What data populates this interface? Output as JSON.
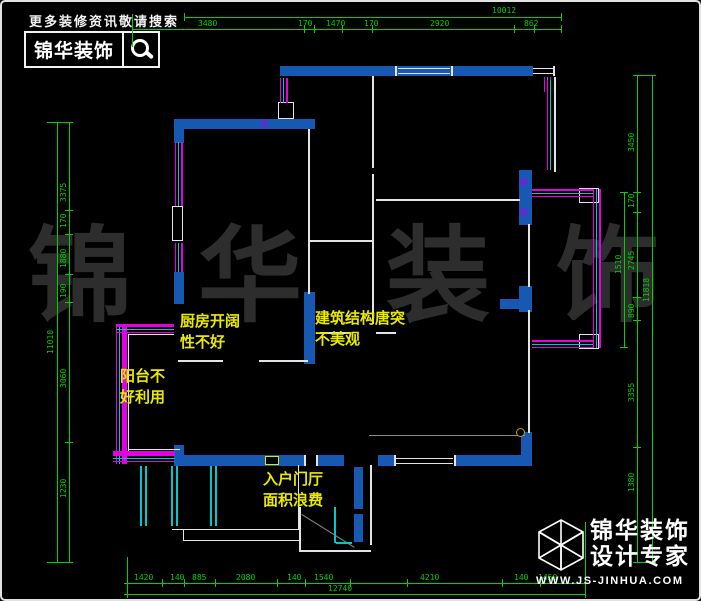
{
  "header": {
    "tagline": "更多装修资讯敬请搜索",
    "brand": "锦华装饰",
    "icon": "magnifier-icon"
  },
  "footer": {
    "brand": "锦华装饰",
    "subtitle": "设计专家",
    "website": "WWW.JS-JINHUA.COM",
    "icon": "cube-logo-icon"
  },
  "watermark": {
    "chars": [
      {
        "t": "锦",
        "x": 26
      },
      {
        "t": "华",
        "x": 196
      },
      {
        "t": "装",
        "x": 384
      },
      {
        "t": "饰",
        "x": 554
      }
    ]
  },
  "colors": {
    "wall": "#1658b2",
    "line": "#e4e4e4",
    "green": "#00d200",
    "magenta": "#e400e4",
    "cyan": "#00c8c8",
    "yellow": "#e3e300",
    "violet": "#5a2fd0",
    "gray": "#8a8a8a",
    "amber": "#cf9a00"
  },
  "plan": {
    "notes": [
      {
        "t": "厨房开阔\n性不好",
        "x": 178,
        "y": 309
      },
      {
        "t": "建筑结构唐突\n不美观",
        "x": 313,
        "y": 306
      },
      {
        "t": "阳台不\n好利用",
        "x": 118,
        "y": 364
      },
      {
        "t": "入户门厅\n面积浪费",
        "x": 261,
        "y": 467
      }
    ],
    "dim_labels": [
      {
        "t": "10012",
        "x": 490,
        "y": 5
      },
      {
        "t": "3480",
        "x": 196,
        "y": 18
      },
      {
        "t": "170",
        "x": 296,
        "y": 18
      },
      {
        "t": "1470",
        "x": 324,
        "y": 18
      },
      {
        "t": "170",
        "x": 362,
        "y": 18
      },
      {
        "t": "2920",
        "x": 428,
        "y": 18
      },
      {
        "t": "862",
        "x": 522,
        "y": 18
      },
      {
        "t": "1420",
        "x": 132,
        "y": 572
      },
      {
        "t": "140",
        "x": 168,
        "y": 572
      },
      {
        "t": "885",
        "x": 190,
        "y": 572
      },
      {
        "t": "2080",
        "x": 234,
        "y": 572
      },
      {
        "t": "140",
        "x": 285,
        "y": 572
      },
      {
        "t": "1540",
        "x": 312,
        "y": 572
      },
      {
        "t": "4210",
        "x": 418,
        "y": 572
      },
      {
        "t": "140",
        "x": 512,
        "y": 572
      },
      {
        "t": "1450",
        "x": 536,
        "y": 572
      },
      {
        "t": "12740",
        "x": 326,
        "y": 583
      },
      {
        "t": "3375",
        "x": 58,
        "y": 200,
        "rot": 1
      },
      {
        "t": "170",
        "x": 58,
        "y": 226,
        "rot": 1
      },
      {
        "t": "1880",
        "x": 58,
        "y": 266,
        "rot": 1
      },
      {
        "t": "190",
        "x": 58,
        "y": 296,
        "rot": 1
      },
      {
        "t": "3060",
        "x": 58,
        "y": 386,
        "rot": 1
      },
      {
        "t": "1230",
        "x": 58,
        "y": 496,
        "rot": 1
      },
      {
        "t": "11010",
        "x": 45,
        "y": 352,
        "rot": 1
      },
      {
        "t": "3450",
        "x": 626,
        "y": 150,
        "rot": 1
      },
      {
        "t": "170",
        "x": 626,
        "y": 206,
        "rot": 1
      },
      {
        "t": "2745",
        "x": 626,
        "y": 268,
        "rot": 1
      },
      {
        "t": "890",
        "x": 626,
        "y": 316,
        "rot": 1
      },
      {
        "t": "3355",
        "x": 626,
        "y": 400,
        "rot": 1
      },
      {
        "t": "1380",
        "x": 626,
        "y": 490,
        "rot": 1
      },
      {
        "t": "11818",
        "x": 641,
        "y": 300,
        "rot": 1
      },
      {
        "t": "1510",
        "x": 613,
        "y": 272,
        "rot": 1
      }
    ],
    "ticks": [
      {
        "y": 11,
        "xs": [
          182,
          559
        ]
      },
      {
        "y": 23,
        "xs": [
          130,
          302,
          312,
          340,
          370,
          512,
          532,
          559
        ]
      },
      {
        "y": 577,
        "xs": [
          125,
          160,
          182,
          213,
          275,
          303,
          348,
          405,
          500,
          538,
          583
        ]
      },
      {
        "y": 588,
        "xs": [
          125,
          583
        ]
      },
      {
        "x": 51,
        "ys": [
          120,
          560
        ]
      },
      {
        "x": 63,
        "ys": [
          120,
          208,
          232,
          272,
          300,
          440,
          560
        ]
      },
      {
        "x": 631,
        "ys": [
          73,
          190,
          210,
          295,
          318,
          445,
          560
        ]
      },
      {
        "x": 646,
        "ys": [
          73,
          560
        ]
      },
      {
        "x": 618,
        "ys": [
          190,
          345
        ]
      }
    ],
    "rects": [
      {
        "n": "wall-segment",
        "x": 278,
        "y": 64,
        "w": 253,
        "h": 10,
        "f": "wall"
      },
      {
        "n": "wall-segment",
        "x": 172,
        "y": 117,
        "w": 141,
        "h": 10,
        "f": "wall"
      },
      {
        "n": "wall-segment",
        "x": 172,
        "y": 117,
        "w": 10,
        "h": 24,
        "f": "wall"
      },
      {
        "n": "wall-segment",
        "x": 172,
        "y": 270,
        "w": 10,
        "h": 32,
        "f": "wall"
      },
      {
        "n": "wall-segment",
        "x": 302,
        "y": 290,
        "w": 11,
        "h": 72,
        "f": "wall"
      },
      {
        "n": "wall-segment",
        "x": 517,
        "y": 168,
        "w": 13,
        "h": 55,
        "f": "wall"
      },
      {
        "n": "wall-segment",
        "x": 517,
        "y": 284,
        "w": 13,
        "h": 26,
        "f": "wall"
      },
      {
        "n": "wall-segment",
        "x": 498,
        "y": 297,
        "w": 19,
        "h": 10,
        "f": "wall"
      },
      {
        "n": "wall-segment",
        "x": 519,
        "y": 430,
        "w": 11,
        "h": 34,
        "f": "wall"
      },
      {
        "n": "wall-segment",
        "x": 172,
        "y": 443,
        "w": 10,
        "h": 21,
        "f": "wall"
      },
      {
        "n": "wall-segment",
        "x": 172,
        "y": 453,
        "w": 82,
        "h": 11,
        "f": "wall"
      },
      {
        "n": "wall-segment",
        "x": 253,
        "y": 453,
        "w": 49,
        "h": 11,
        "f": "wall"
      },
      {
        "n": "wall-segment",
        "x": 316,
        "y": 453,
        "w": 26,
        "h": 11,
        "f": "wall"
      },
      {
        "n": "wall-segment",
        "x": 376,
        "y": 453,
        "w": 17,
        "h": 11,
        "f": "wall"
      },
      {
        "n": "wall-segment",
        "x": 453,
        "y": 453,
        "w": 77,
        "h": 11,
        "f": "wall"
      },
      {
        "n": "door-jamb",
        "x": 352,
        "y": 465,
        "w": 9,
        "h": 42,
        "f": "wall"
      },
      {
        "n": "door-jamb",
        "x": 352,
        "y": 512,
        "w": 9,
        "h": 28,
        "f": "wall"
      },
      {
        "n": "partition-line",
        "x": 306,
        "y": 127,
        "w": 2,
        "h": 165,
        "f": "line"
      },
      {
        "n": "partition-line",
        "x": 307,
        "y": 238,
        "w": 64,
        "h": 2,
        "f": "line"
      },
      {
        "n": "partition-line",
        "x": 370,
        "y": 74,
        "w": 2,
        "h": 92,
        "f": "line"
      },
      {
        "n": "partition-line",
        "x": 370,
        "y": 172,
        "w": 2,
        "h": 150,
        "f": "line"
      },
      {
        "n": "partition-line",
        "x": 374,
        "y": 197,
        "w": 144,
        "h": 2,
        "f": "line"
      },
      {
        "n": "partition-line",
        "x": 176,
        "y": 358,
        "w": 45,
        "h": 2,
        "f": "line"
      },
      {
        "n": "partition-line",
        "x": 257,
        "y": 358,
        "w": 49,
        "h": 2,
        "f": "line"
      },
      {
        "n": "partition-line",
        "x": 526,
        "y": 222,
        "w": 2,
        "h": 63,
        "f": "line"
      },
      {
        "n": "partition-line",
        "x": 526,
        "y": 308,
        "w": 2,
        "h": 123,
        "f": "line"
      },
      {
        "n": "partition-line",
        "x": 318,
        "y": 330,
        "w": 30,
        "h": 2,
        "f": "line"
      },
      {
        "n": "partition-line",
        "x": 374,
        "y": 330,
        "w": 20,
        "h": 2,
        "f": "line"
      },
      {
        "n": "floor-line",
        "x": 367,
        "y": 433,
        "w": 156,
        "h": 1,
        "f": "gray"
      },
      {
        "n": "opening-cap",
        "x": 393,
        "y": 64,
        "w": 2,
        "h": 10,
        "f": "line"
      },
      {
        "n": "opening-cap",
        "x": 449,
        "y": 64,
        "w": 2,
        "h": 10,
        "f": "line"
      },
      {
        "n": "opening-line",
        "x": 396,
        "y": 66,
        "w": 52,
        "h": 1,
        "f": "line"
      },
      {
        "n": "opening-line",
        "x": 396,
        "y": 71,
        "w": 52,
        "h": 1,
        "f": "line"
      },
      {
        "n": "opening-line",
        "x": 531,
        "y": 66,
        "w": 21,
        "h": 1,
        "f": "line"
      },
      {
        "n": "opening-line",
        "x": 531,
        "y": 71,
        "w": 21,
        "h": 1,
        "f": "line"
      },
      {
        "n": "opening-cap",
        "x": 551,
        "y": 64,
        "w": 2,
        "h": 10,
        "f": "line"
      },
      {
        "n": "exterior-line",
        "x": 552,
        "y": 75,
        "w": 2,
        "h": 95,
        "f": "line"
      },
      {
        "n": "opening-cap",
        "x": 392,
        "y": 453,
        "w": 2,
        "h": 11,
        "f": "line"
      },
      {
        "n": "opening-cap",
        "x": 452,
        "y": 453,
        "w": 2,
        "h": 11,
        "f": "line"
      },
      {
        "n": "opening-line",
        "x": 394,
        "y": 456,
        "w": 57,
        "h": 1,
        "f": "line"
      },
      {
        "n": "opening-line",
        "x": 394,
        "y": 461,
        "w": 57,
        "h": 1,
        "f": "line"
      },
      {
        "n": "opening-cap",
        "x": 302,
        "y": 453,
        "w": 2,
        "h": 11,
        "f": "line"
      },
      {
        "n": "opening-cap",
        "x": 314,
        "y": 453,
        "w": 2,
        "h": 11,
        "f": "line"
      },
      {
        "n": "wall-niche-box",
        "x": 276,
        "y": 100,
        "w": 16,
        "h": 17,
        "o": 1
      },
      {
        "n": "wall-niche-box",
        "x": 170,
        "y": 204,
        "w": 11,
        "h": 35,
        "o": 1
      },
      {
        "n": "bay-corner-box",
        "x": 577,
        "y": 186,
        "w": 20,
        "h": 15,
        "o": 1
      },
      {
        "n": "bay-corner-box",
        "x": 577,
        "y": 332,
        "w": 20,
        "h": 15,
        "o": 1
      },
      {
        "n": "steps-line",
        "x": 170,
        "y": 527,
        "w": 127,
        "h": 1,
        "f": "line"
      },
      {
        "n": "steps-line",
        "x": 296,
        "y": 463,
        "w": 1,
        "h": 65,
        "f": "line"
      },
      {
        "n": "steps-line",
        "x": 181,
        "y": 538,
        "w": 116,
        "h": 1,
        "f": "line"
      },
      {
        "n": "steps-line",
        "x": 181,
        "y": 527,
        "w": 1,
        "h": 11,
        "f": "line"
      },
      {
        "n": "entry-line",
        "x": 368,
        "y": 463,
        "w": 2,
        "h": 80,
        "f": "line"
      },
      {
        "n": "entry-line",
        "x": 297,
        "y": 505,
        "w": 2,
        "h": 44,
        "f": "line"
      },
      {
        "n": "entry-line",
        "x": 297,
        "y": 548,
        "w": 72,
        "h": 2,
        "f": "line"
      },
      {
        "n": "balcony-line",
        "x": 126,
        "y": 332,
        "w": 1,
        "h": 118,
        "f": "line"
      },
      {
        "n": "balcony-line",
        "x": 127,
        "y": 332,
        "w": 45,
        "h": 1,
        "f": "line"
      },
      {
        "n": "balcony-line",
        "x": 127,
        "y": 447,
        "w": 51,
        "h": 1,
        "f": "line"
      },
      {
        "n": "window-band",
        "x": 173,
        "y": 140,
        "w": 8,
        "h": 64,
        "cls": "stripeV"
      },
      {
        "n": "window-band",
        "x": 173,
        "y": 241,
        "w": 8,
        "h": 29,
        "cls": "stripeV"
      },
      {
        "n": "window-band",
        "x": 278,
        "y": 76,
        "w": 8,
        "h": 25,
        "cls": "stripeV"
      },
      {
        "n": "window-band",
        "x": 542,
        "y": 75,
        "w": 7,
        "h": 15,
        "cls": "stripeV"
      },
      {
        "n": "window-band",
        "x": 545,
        "y": 78,
        "w": 6,
        "h": 90,
        "cls": "stripeV"
      },
      {
        "n": "balcony-window-band",
        "x": 114,
        "y": 322,
        "w": 11,
        "h": 140,
        "cls": "stripeV"
      },
      {
        "n": "balcony-window-band",
        "x": 114,
        "y": 322,
        "w": 58,
        "h": 9,
        "cls": "stripeH"
      },
      {
        "n": "balcony-window-band",
        "x": 111,
        "y": 449,
        "w": 62,
        "h": 11,
        "cls": "stripeH"
      },
      {
        "n": "bay-window-band",
        "x": 530,
        "y": 187,
        "w": 62,
        "h": 8,
        "cls": "stripeH"
      },
      {
        "n": "bay-window-band",
        "x": 530,
        "y": 338,
        "w": 62,
        "h": 8,
        "cls": "stripeH"
      },
      {
        "n": "bay-window-band",
        "x": 591,
        "y": 187,
        "w": 8,
        "h": 159,
        "cls": "stripeV"
      },
      {
        "n": "curtain-line",
        "x": 138,
        "y": 464,
        "w": 2,
        "h": 60,
        "f": "cyan"
      },
      {
        "n": "curtain-line",
        "x": 143,
        "y": 464,
        "w": 2,
        "h": 60,
        "f": "cyan"
      },
      {
        "n": "curtain-line",
        "x": 169,
        "y": 464,
        "w": 2,
        "h": 60,
        "f": "cyan"
      },
      {
        "n": "curtain-line",
        "x": 174,
        "y": 464,
        "w": 2,
        "h": 60,
        "f": "cyan"
      },
      {
        "n": "curtain-line",
        "x": 208,
        "y": 464,
        "w": 2,
        "h": 60,
        "f": "cyan"
      },
      {
        "n": "curtain-line",
        "x": 213,
        "y": 464,
        "w": 2,
        "h": 60,
        "f": "cyan"
      },
      {
        "n": "door-leaf",
        "x": 332,
        "y": 505,
        "w": 2,
        "h": 36,
        "f": "cyan"
      },
      {
        "n": "door-leaf",
        "x": 334,
        "y": 540,
        "w": 16,
        "h": 2,
        "f": "cyan"
      },
      {
        "n": "door-swing",
        "x": 300,
        "y": 512,
        "w": 62,
        "h": 1,
        "f": "gray",
        "rot": 32
      },
      {
        "n": "column-dot",
        "x": 259,
        "y": 118,
        "w": 7,
        "h": 7,
        "f": "violet",
        "rd": 1
      },
      {
        "n": "column-dot",
        "x": 518,
        "y": 176,
        "w": 8,
        "h": 8,
        "f": "violet",
        "rd": 1
      },
      {
        "n": "column-dot",
        "x": 518,
        "y": 206,
        "w": 8,
        "h": 8,
        "f": "violet",
        "rd": 1
      },
      {
        "n": "fixture-ring",
        "x": 514,
        "y": 426,
        "w": 9,
        "h": 9,
        "o": 1,
        "oc": "amber",
        "rd": 1
      },
      {
        "n": "door-symbol-box",
        "x": 263,
        "y": 454,
        "w": 14,
        "h": 9,
        "o": 1,
        "oc": "yellow"
      },
      {
        "n": "dim-line",
        "x": 182,
        "y": 15,
        "w": 377,
        "h": 1,
        "f": "green"
      },
      {
        "n": "dim-line",
        "x": 130,
        "y": 27,
        "w": 429,
        "h": 1,
        "f": "green"
      },
      {
        "n": "dim-line",
        "x": 122,
        "y": 581,
        "w": 461,
        "h": 1,
        "f": "green"
      },
      {
        "n": "dim-line",
        "x": 122,
        "y": 592,
        "w": 461,
        "h": 1,
        "f": "green"
      },
      {
        "n": "dim-line",
        "x": 55,
        "y": 120,
        "w": 1,
        "h": 440,
        "f": "green"
      },
      {
        "n": "dim-line",
        "x": 67,
        "y": 120,
        "w": 1,
        "h": 440,
        "f": "green"
      },
      {
        "n": "dim-line",
        "x": 635,
        "y": 73,
        "w": 1,
        "h": 487,
        "f": "green"
      },
      {
        "n": "dim-line",
        "x": 650,
        "y": 73,
        "w": 1,
        "h": 487,
        "f": "green"
      },
      {
        "n": "dim-line",
        "x": 622,
        "y": 190,
        "w": 1,
        "h": 155,
        "f": "green"
      },
      {
        "n": "dim-extension",
        "x": 130,
        "y": 12,
        "w": 1,
        "h": 33,
        "f": "green"
      },
      {
        "n": "dim-extension",
        "x": 125,
        "y": 555,
        "w": 1,
        "h": 40,
        "f": "green"
      },
      {
        "n": "dim-extension",
        "x": 583,
        "y": 520,
        "w": 1,
        "h": 72,
        "f": "green"
      },
      {
        "n": "dim-extension",
        "x": 45,
        "y": 120,
        "w": 24,
        "h": 1,
        "f": "green"
      },
      {
        "n": "dim-extension",
        "x": 45,
        "y": 560,
        "w": 24,
        "h": 1,
        "f": "green"
      },
      {
        "n": "dim-extension",
        "x": 631,
        "y": 73,
        "w": 22,
        "h": 1,
        "f": "green"
      },
      {
        "n": "dim-extension",
        "x": 631,
        "y": 560,
        "w": 22,
        "h": 1,
        "f": "green"
      },
      {
        "n": "dim-extension",
        "x": 618,
        "y": 190,
        "w": 8,
        "h": 1,
        "f": "green"
      },
      {
        "n": "dim-extension",
        "x": 618,
        "y": 345,
        "w": 8,
        "h": 1,
        "f": "green"
      }
    ]
  }
}
